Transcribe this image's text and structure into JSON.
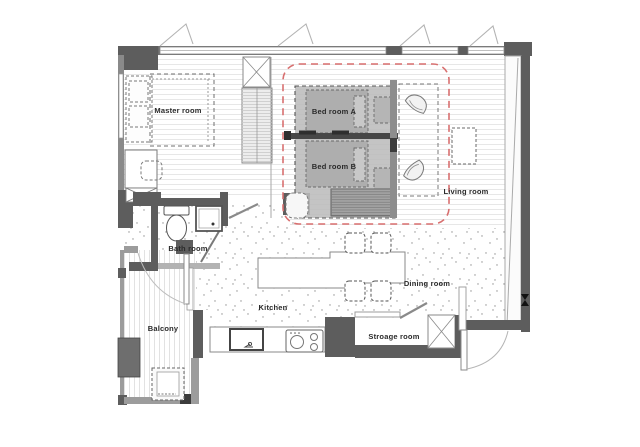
{
  "rooms": [
    {
      "label": "Master room"
    },
    {
      "label": "Bed room A"
    },
    {
      "label": "Bed room B"
    },
    {
      "label": "Living room"
    },
    {
      "label": "Bath room"
    },
    {
      "label": "Kitchen"
    },
    {
      "label": "Dining room"
    },
    {
      "label": "Stroage room"
    },
    {
      "label": "Balcony"
    }
  ],
  "colors": {
    "wall": "#5d5d5d",
    "light_wall": "#9c9c9c",
    "bedroom_zone_fill": "#bcbcbc",
    "renovation_outline": "#d86f6f",
    "floor_stripe": "#e7e7e7",
    "speckle": "#909090"
  }
}
